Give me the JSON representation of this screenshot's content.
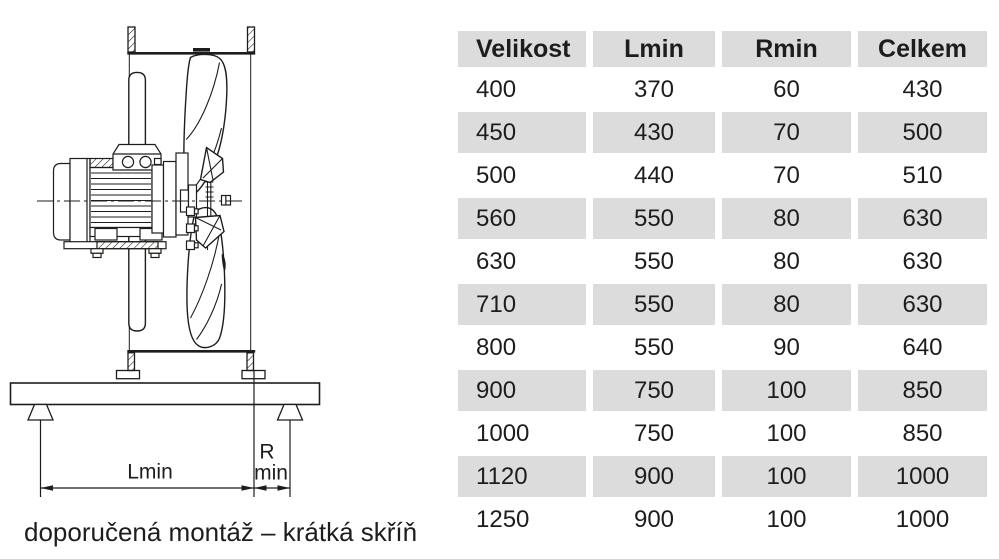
{
  "diagram": {
    "caption": "doporučená montáž – krátká skříň",
    "dim_length_label": "Lmin",
    "dim_radius_label": "R",
    "dim_radius_sub": "min"
  },
  "table": {
    "headers": [
      "Velikost",
      "Lmin",
      "Rmin",
      "Celkem"
    ],
    "rows": [
      [
        "400",
        "370",
        "60",
        "430"
      ],
      [
        "450",
        "430",
        "70",
        "500"
      ],
      [
        "500",
        "440",
        "70",
        "510"
      ],
      [
        "560",
        "550",
        "80",
        "630"
      ],
      [
        "630",
        "550",
        "80",
        "630"
      ],
      [
        "710",
        "550",
        "80",
        "630"
      ],
      [
        "800",
        "550",
        "90",
        "640"
      ],
      [
        "900",
        "750",
        "100",
        "850"
      ],
      [
        "1000",
        "750",
        "100",
        "850"
      ],
      [
        "1120",
        "900",
        "100",
        "1000"
      ],
      [
        "1250",
        "900",
        "100",
        "1000"
      ]
    ]
  },
  "colors": {
    "ink": "#1d1d1b",
    "row_alt": "#dcdcdc"
  }
}
